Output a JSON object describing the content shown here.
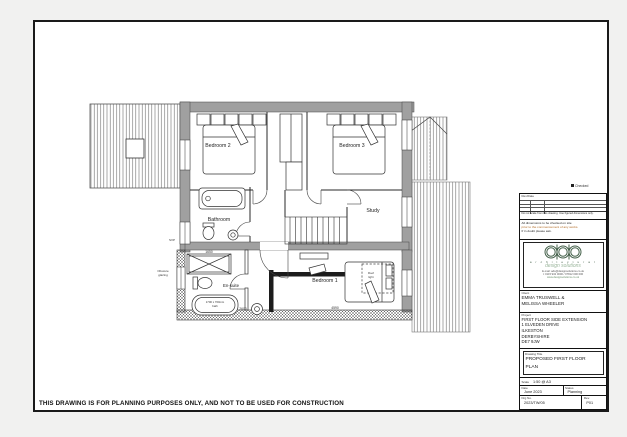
{
  "page": {
    "disclaimer": "THIS DRAWING IS FOR PLANNING PURPOSES ONLY, AND NOT TO BE USED FOR CONSTRUCTION",
    "checked_label": "Checked"
  },
  "plan": {
    "rooms": {
      "bedroom2": "Bedroom 2",
      "bedroom3": "Bedroom 3",
      "bathroom": "Bathroom",
      "study": "Study",
      "bedroom1": "Bedroom 1",
      "ensuite": "En-suite"
    },
    "annotations": {
      "svp": "SVP",
      "obscure1": "Obscure",
      "obscure2": "glazing",
      "bath_size1": "1700 x 700mm",
      "bath_size2": "bath",
      "rooflight1": "Roof",
      "rooflight2": "light",
      "dim_shower": "1650",
      "dim_bath": "2600",
      "dim_bed1": "4590"
    }
  },
  "titleblock": {
    "rev_label": "Rev/Date",
    "rev_caption": "Do not scale from this drawing. Use figured dimensions only.",
    "notes": [
      "All dimensions to be checked on site",
      "prior to the commencement of any works.",
      "If in doubt please ask."
    ],
    "logo": {
      "name": "a r c h i t e c t u r a l",
      "sub": "design solutions",
      "contact1": "E-mail: ads@designsolutions.co.uk",
      "contact2": "t: 0115 932 0000 / 07812 000 000",
      "contact3": "www.designsolutions.co.uk"
    },
    "client_label": "Client",
    "client": [
      "EMMA TRUSWELL &",
      "MELISSA WHEELER"
    ],
    "project_label": "Project",
    "project": [
      "FIRST FLOOR SIDE EXTENSION",
      "1 ELVEDEN DRIVE",
      "ILKESTON",
      "DERBYSHIRE",
      "DE7 9JW"
    ],
    "title_label": "Drawing Title",
    "title": [
      "PROPOSED FIRST FLOOR",
      "PLAN"
    ],
    "scale_label": "Scale",
    "scale": "1:50 @ A3",
    "date_label": "Date",
    "date": "June 2023",
    "status_label": "Status",
    "status": "Planning",
    "drg_label": "Drg No.",
    "drg_no": "2023/TW/05",
    "rev_no_label": "Rev.",
    "rev_no": "P01"
  }
}
